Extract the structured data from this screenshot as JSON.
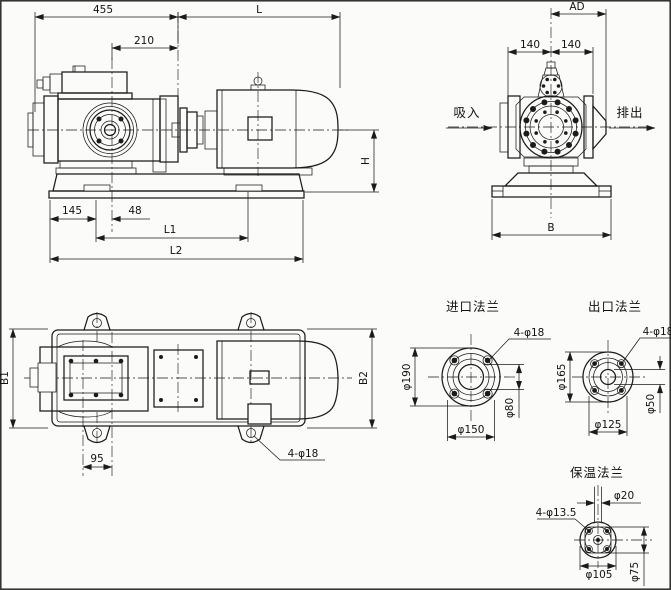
{
  "colors": {
    "line": "#1b1b1b",
    "paper": "#fbfbf9"
  },
  "side_view": {
    "dim_455": "455",
    "dim_210": "210",
    "dim_L": "L",
    "dim_145": "145",
    "dim_48": "48",
    "dim_L1": "L1",
    "dim_L2": "L2",
    "dim_H": "H"
  },
  "end_view": {
    "dim_AD": "AD",
    "dim_140_left": "140",
    "dim_140_right": "140",
    "dim_B": "B",
    "label_suction": "吸入",
    "label_discharge": "排出"
  },
  "plan_view": {
    "dim_B1": "B1",
    "dim_B2": "B2",
    "dim_95": "95",
    "label_holes": "4-φ18"
  },
  "flange_inlet": {
    "title": "进口法兰",
    "dim_od": "φ190",
    "dim_bolt_circle": "φ150",
    "dim_bore": "φ80",
    "label_holes": "4-φ18"
  },
  "flange_outlet": {
    "title": "出口法兰",
    "dim_od": "φ165",
    "dim_bolt_circle": "φ125",
    "dim_bore": "φ50",
    "label_holes": "4-φ18"
  },
  "flange_insulation": {
    "title": "保温法兰",
    "dim_pipe": "φ20",
    "dim_holes": "4-φ13.5",
    "dim_od": "φ105",
    "dim_bolt_circle": "φ75"
  }
}
